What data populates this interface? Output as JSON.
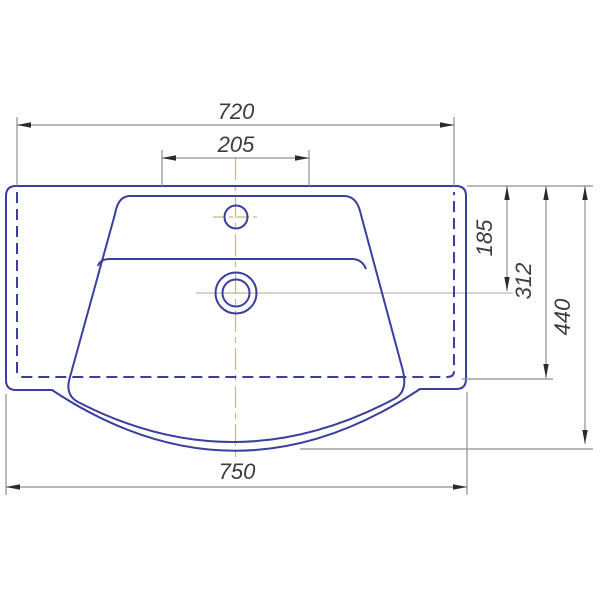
{
  "drawing": {
    "kind": "washbasin-technical-drawing-top-view",
    "units_shown": false,
    "colors": {
      "outline_blue": "#3b3f9e",
      "dimension_gray": "#8f8f8f",
      "arrow_black": "#2b2b2b",
      "label_text": "#3c3c3c",
      "centerline_tan": "#c9b87e",
      "background": "#ffffff"
    },
    "dimensions": {
      "back_mount_width": "720",
      "faucet_area_width": "205",
      "top_to_drain_center": "185",
      "top_to_body_edge": "312",
      "overall_depth": "440",
      "overall_width": "750"
    }
  }
}
